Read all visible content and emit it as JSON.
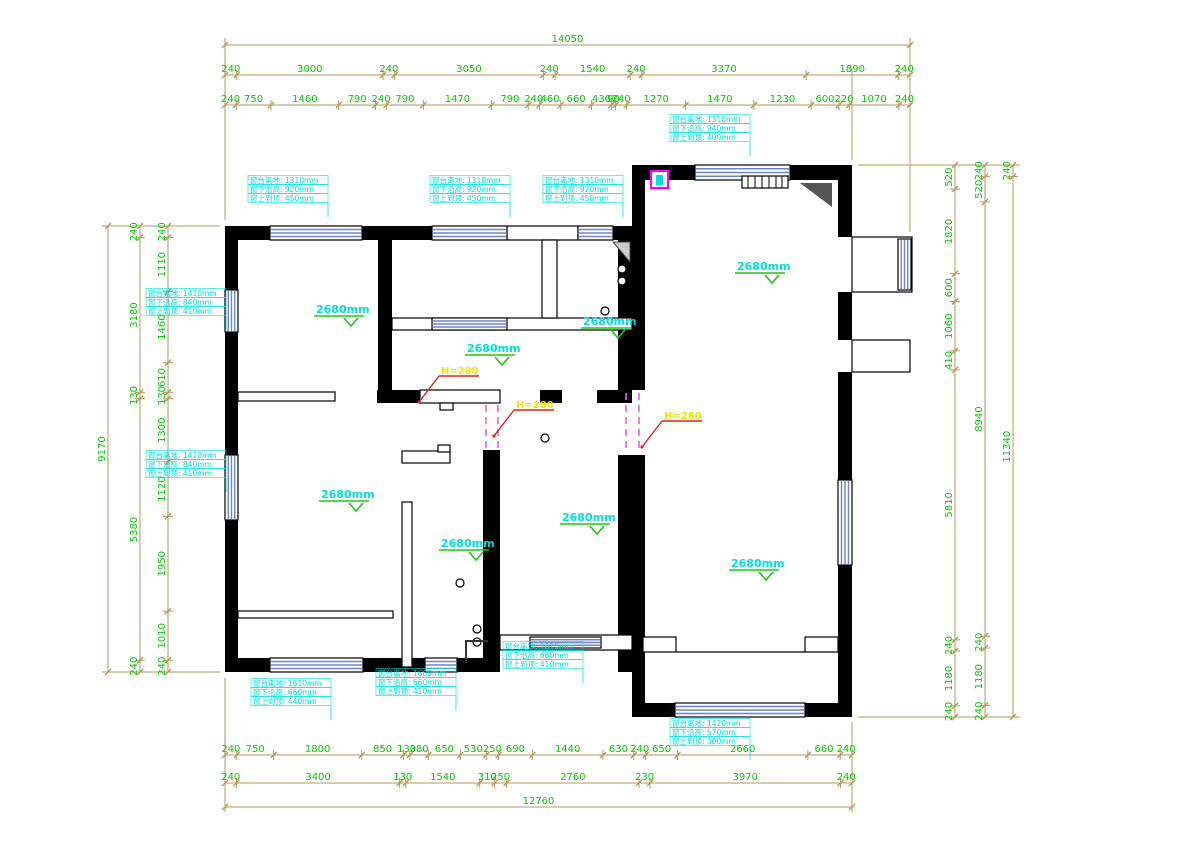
{
  "drawing": {
    "type": "floor-plan",
    "units": "mm"
  },
  "colors": {
    "wall": "#000000",
    "dim_line": "#b39a5c",
    "dim_text": "#00cc00",
    "window_stripe": "#6e86c8",
    "annotation_cyan": "#00dede",
    "ceiling_text": "#00dede",
    "check_green": "#22c514",
    "beam_text": "#f0e400",
    "beam_leader": "#dd2222",
    "beam_dash": "#e660e6",
    "symbol_magenta": "#ff00ff"
  },
  "dimensions": {
    "top_total": {
      "values": [
        14050
      ]
    },
    "top_row2": {
      "values": [
        240,
        3000,
        240,
        3050,
        240,
        1540,
        240,
        3370,
        1890,
        240
      ]
    },
    "top_row3": {
      "values": [
        240,
        750,
        1460,
        790,
        240,
        790,
        1470,
        790,
        240,
        460,
        660,
        430,
        90,
        240,
        1270,
        1470,
        1230,
        600,
        220,
        1070,
        240
      ]
    },
    "bottom_row1": {
      "values": [
        240,
        750,
        1800,
        850,
        130,
        380,
        650,
        530,
        250,
        690,
        1440,
        630,
        240,
        650,
        2660,
        660,
        240
      ]
    },
    "bottom_row2": {
      "values": [
        240,
        3400,
        130,
        1540,
        310,
        250,
        2760,
        230,
        3970,
        240
      ]
    },
    "bottom_total": {
      "values": [
        12760
      ]
    },
    "left_outer": {
      "values": [
        9170
      ]
    },
    "left_mid": {
      "values": [
        240,
        3180,
        130,
        5380,
        240
      ]
    },
    "left_inner": {
      "values": [
        240,
        1110,
        1460,
        610,
        130,
        1300,
        1120,
        1950,
        1010,
        240
      ]
    },
    "right_inner": {
      "values": [
        520,
        1820,
        600,
        1060,
        410,
        5810,
        240,
        1180,
        240
      ]
    },
    "right_mid": {
      "values": [
        240,
        520,
        8940,
        240,
        1180,
        240
      ]
    },
    "right_outer": {
      "values": [
        240,
        11340
      ]
    }
  },
  "ceiling_labels": [
    {
      "id": "cl1",
      "text": "2680mm"
    },
    {
      "id": "cl2",
      "text": "2680mm"
    },
    {
      "id": "cl3",
      "text": "2680mm"
    },
    {
      "id": "cl4",
      "text": "2680mm"
    },
    {
      "id": "cl5",
      "text": "2680mm"
    },
    {
      "id": "cl6",
      "text": "2680mm"
    },
    {
      "id": "cl7",
      "text": "2680mm"
    },
    {
      "id": "cl8",
      "text": "2680mm"
    }
  ],
  "beam_labels": [
    {
      "id": "b1",
      "text": "H=280"
    },
    {
      "id": "b2",
      "text": "H=280"
    },
    {
      "id": "b3",
      "text": "H=280"
    }
  ],
  "window_annotations": [
    {
      "id": "w1",
      "lines": [
        "窗台离地: 1310mm",
        "窗下沿高: 920mm",
        "窗上到顶: 450mm"
      ]
    },
    {
      "id": "w2",
      "lines": [
        "窗台离地: 1310mm",
        "窗下沿高: 920mm",
        "窗上到顶: 450mm"
      ]
    },
    {
      "id": "w3",
      "lines": [
        "窗台离地: 1310mm",
        "窗下沿高: 920mm",
        "窗上到顶: 450mm"
      ]
    },
    {
      "id": "w4",
      "lines": [
        "窗台离地: 1310mm",
        "窗下沿高: 940mm",
        "窗上到顶: 400mm"
      ]
    },
    {
      "id": "w5",
      "lines": [
        "窗台离地: 1410mm",
        "窗下沿高: 840mm",
        "窗上到顶: 410mm"
      ]
    },
    {
      "id": "w6",
      "lines": [
        "窗台离地: 1410mm",
        "窗下沿高: 840mm",
        "窗上到顶: 410mm"
      ]
    },
    {
      "id": "w7",
      "lines": [
        "窗台离地: 1610mm",
        "窗下沿高: 660mm",
        "窗上到顶: 440mm"
      ]
    },
    {
      "id": "w8",
      "lines": [
        "窗台离地: 1600mm",
        "窗下沿高: 660mm",
        "窗上到顶: 410mm"
      ]
    },
    {
      "id": "w9",
      "lines": [
        "窗台离地: 1610mm",
        "窗下沿高: 660mm",
        "窗上到顶: 410mm"
      ]
    },
    {
      "id": "w10",
      "lines": [
        "窗台离地: 1420mm",
        "窗下沿高: 570mm",
        "窗上到顶: 300mm"
      ]
    }
  ]
}
